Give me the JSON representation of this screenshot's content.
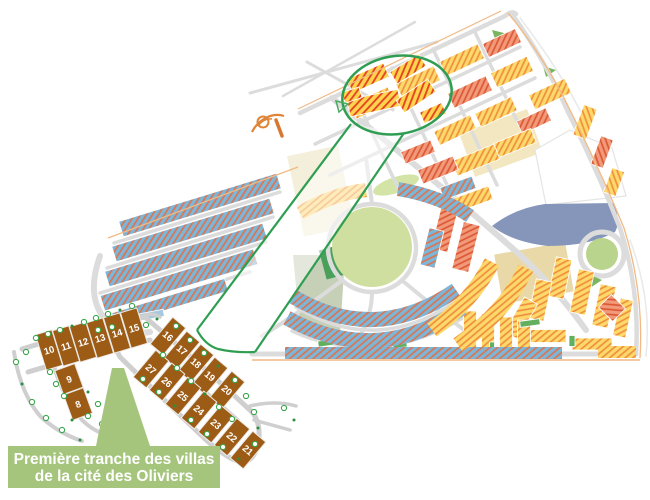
{
  "caption": {
    "line1": "Première tranche des villas",
    "line2": "de la cité des Oliviers"
  },
  "colors": {
    "parcel_brown": "#9d5c16",
    "tree_green": "#3aa64a",
    "tree_dot": "#2e8f3e",
    "caption_bg": "#a5c57d",
    "highlight_green": "#2f9e52",
    "yellow_block": "#fdd96b",
    "yellow_stripe": "#ef8b3c",
    "salmon_block": "#f2997a",
    "salmon_stripe": "#da5531",
    "blue_block": "#7cb6d9",
    "blue_stripe": "#e0714a",
    "hl_yellow": "#ffd34d",
    "hl_red_stripe": "#e33f22",
    "road_gray": "#dcdcdc",
    "boundary_orange": "#f2b983",
    "park_green": "#cfdf9f",
    "dark_green": "#4aa05a",
    "sage_green": "#c6d0b6",
    "big_block_bluegray": "#8596ba",
    "solid_green": "#62b05e",
    "pale_yellow": "#f7e8ac",
    "pale_blue": "#a6c8e0"
  },
  "inset": {
    "parcels": [
      {
        "n": "8",
        "x": 78,
        "y": 404,
        "w": 21,
        "h": 27,
        "r": -20
      },
      {
        "n": "9",
        "x": 69,
        "y": 379,
        "w": 21,
        "h": 25,
        "r": -20
      },
      {
        "n": "10",
        "x": 49,
        "y": 350,
        "w": 17,
        "h": 37,
        "r": -17
      },
      {
        "n": "11",
        "x": 66,
        "y": 346,
        "w": 17,
        "h": 37,
        "r": -17
      },
      {
        "n": "12",
        "x": 83,
        "y": 342,
        "w": 17,
        "h": 37,
        "r": -17
      },
      {
        "n": "13",
        "x": 100,
        "y": 338,
        "w": 17,
        "h": 37,
        "r": -17
      },
      {
        "n": "14",
        "x": 117,
        "y": 333,
        "w": 17,
        "h": 37,
        "r": -17
      },
      {
        "n": "15",
        "x": 134,
        "y": 328,
        "w": 17,
        "h": 37,
        "r": -17
      },
      {
        "n": "16",
        "x": 168,
        "y": 336,
        "w": 17,
        "h": 35,
        "r": 40
      },
      {
        "n": "17",
        "x": 182,
        "y": 350,
        "w": 17,
        "h": 35,
        "r": 40
      },
      {
        "n": "18",
        "x": 196,
        "y": 363,
        "w": 17,
        "h": 35,
        "r": 40
      },
      {
        "n": "19",
        "x": 210,
        "y": 376,
        "w": 17,
        "h": 35,
        "r": 40
      },
      {
        "n": "20",
        "x": 227,
        "y": 390,
        "w": 17,
        "h": 35,
        "r": 40
      },
      {
        "n": "21",
        "x": 248,
        "y": 450,
        "w": 17,
        "h": 35,
        "r": 40
      },
      {
        "n": "22",
        "x": 232,
        "y": 437,
        "w": 17,
        "h": 35,
        "r": 40
      },
      {
        "n": "23",
        "x": 216,
        "y": 424,
        "w": 17,
        "h": 35,
        "r": 40
      },
      {
        "n": "24",
        "x": 199,
        "y": 410,
        "w": 17,
        "h": 35,
        "r": 40
      },
      {
        "n": "25",
        "x": 183,
        "y": 396,
        "w": 17,
        "h": 35,
        "r": 40
      },
      {
        "n": "26",
        "x": 167,
        "y": 382,
        "w": 17,
        "h": 35,
        "r": 40
      },
      {
        "n": "27",
        "x": 151,
        "y": 369,
        "w": 17,
        "h": 35,
        "r": 40
      }
    ],
    "trees": [
      [
        36,
        338
      ],
      [
        48,
        334
      ],
      [
        60,
        330
      ],
      [
        72,
        326
      ],
      [
        84,
        322
      ],
      [
        96,
        318
      ],
      [
        108,
        314
      ],
      [
        120,
        310
      ],
      [
        132,
        306
      ],
      [
        26,
        352
      ],
      [
        16,
        362
      ],
      [
        22,
        384
      ],
      [
        32,
        402
      ],
      [
        46,
        418
      ],
      [
        62,
        430
      ],
      [
        80,
        440
      ],
      [
        50,
        372
      ],
      [
        56,
        384
      ],
      [
        64,
        396
      ],
      [
        88,
        392
      ],
      [
        98,
        404
      ],
      [
        88,
        416
      ],
      [
        102,
        424
      ],
      [
        72,
        420
      ],
      [
        98,
        330
      ],
      [
        112,
        327
      ],
      [
        146,
        325
      ],
      [
        157,
        319
      ],
      [
        176,
        326
      ],
      [
        190,
        340
      ],
      [
        204,
        353
      ],
      [
        218,
        366
      ],
      [
        235,
        380
      ],
      [
        246,
        396
      ],
      [
        254,
        412
      ],
      [
        258,
        428
      ],
      [
        255,
        444
      ],
      [
        143,
        379
      ],
      [
        159,
        392
      ],
      [
        175,
        406
      ],
      [
        191,
        420
      ],
      [
        207,
        434
      ],
      [
        223,
        447
      ],
      [
        239,
        459
      ],
      [
        163,
        355
      ],
      [
        177,
        368
      ],
      [
        191,
        381
      ],
      [
        205,
        394
      ],
      [
        219,
        407
      ],
      [
        232,
        419
      ],
      [
        284,
        408
      ],
      [
        294,
        420
      ]
    ]
  },
  "map": {
    "blocks": [
      [
        372,
        103,
        42,
        16,
        -25,
        "y"
      ],
      [
        418,
        82,
        42,
        16,
        -25,
        "y"
      ],
      [
        462,
        60,
        42,
        16,
        -25,
        "y"
      ],
      [
        502,
        43,
        36,
        15,
        -25,
        "s"
      ],
      [
        470,
        92,
        42,
        16,
        -25,
        "s"
      ],
      [
        512,
        72,
        40,
        16,
        -25,
        "y"
      ],
      [
        550,
        94,
        40,
        16,
        -25,
        "y"
      ],
      [
        455,
        130,
        40,
        15,
        -25,
        "y"
      ],
      [
        496,
        112,
        40,
        15,
        -25,
        "y"
      ],
      [
        534,
        121,
        32,
        14,
        -25,
        "s"
      ],
      [
        476,
        160,
        46,
        16,
        -22,
        "y"
      ],
      [
        515,
        143,
        40,
        15,
        -22,
        "y"
      ],
      [
        438,
        170,
        38,
        15,
        -22,
        "s"
      ],
      [
        418,
        152,
        32,
        13,
        -22,
        "s"
      ],
      [
        585,
        122,
        32,
        14,
        -70,
        "y"
      ],
      [
        602,
        152,
        30,
        13,
        -70,
        "s"
      ],
      [
        614,
        182,
        26,
        13,
        -70,
        "y"
      ],
      [
        470,
        200,
        44,
        14,
        -20,
        "y"
      ],
      [
        458,
        188,
        34,
        13,
        -20,
        "b"
      ],
      [
        445,
        227,
        17,
        48,
        14,
        "s"
      ],
      [
        466,
        247,
        17,
        48,
        14,
        "s"
      ],
      [
        432,
        248,
        15,
        38,
        14,
        "b"
      ],
      [
        368,
        78,
        40,
        15,
        -24,
        "h"
      ],
      [
        408,
        69,
        34,
        14,
        -32,
        "h"
      ],
      [
        374,
        103,
        52,
        17,
        -12,
        "h"
      ],
      [
        416,
        96,
        38,
        15,
        -34,
        "h"
      ],
      [
        433,
        113,
        24,
        12,
        -24,
        "h"
      ],
      [
        352,
        95,
        18,
        11,
        -18,
        "h"
      ],
      [
        200,
        205,
        165,
        16,
        -17,
        "b"
      ],
      [
        193,
        230,
        165,
        16,
        -17,
        "b"
      ],
      [
        186,
        255,
        165,
        16,
        -17,
        "b"
      ],
      [
        179,
        280,
        160,
        16,
        -17,
        "b"
      ],
      [
        170,
        302,
        118,
        13,
        -17,
        "b"
      ],
      [
        560,
        278,
        16,
        40,
        12,
        "y"
      ],
      [
        582,
        292,
        16,
        44,
        12,
        "y"
      ],
      [
        604,
        306,
        16,
        42,
        12,
        "y"
      ],
      [
        623,
        318,
        13,
        38,
        12,
        "y"
      ],
      [
        540,
        300,
        16,
        40,
        12,
        "y"
      ],
      [
        521,
        318,
        15,
        40,
        30,
        "y"
      ],
      [
        546,
        336,
        40,
        13,
        0,
        "y"
      ],
      [
        592,
        344,
        40,
        12,
        0,
        "y"
      ],
      [
        612,
        308,
        20,
        18,
        45,
        "s"
      ],
      [
        470,
        330,
        13,
        38,
        0,
        "y"
      ],
      [
        488,
        332,
        13,
        36,
        0,
        "y"
      ],
      [
        506,
        334,
        13,
        34,
        0,
        "y"
      ],
      [
        524,
        336,
        13,
        32,
        0,
        "y"
      ],
      [
        530,
        323,
        20,
        6,
        -8,
        "g"
      ],
      [
        492,
        348,
        5,
        12,
        0,
        "g"
      ],
      [
        572,
        341,
        6,
        11,
        0,
        "g"
      ],
      [
        326,
        343,
        16,
        6,
        -8,
        "g"
      ],
      [
        400,
        345,
        14,
        5,
        -5,
        "g"
      ],
      [
        95,
        326,
        50,
        7,
        -11,
        "py"
      ],
      [
        152,
        315,
        24,
        7,
        -11,
        "pb"
      ]
    ],
    "arcs": [
      [
        "M292,296 Q375,346 456,290",
        15,
        "b"
      ],
      [
        "M287,318 Q378,368 462,308",
        15,
        "b"
      ],
      [
        "M285,353 L562,353",
        12,
        "b"
      ],
      [
        "M432,330 Q472,302 492,262",
        16,
        "y"
      ],
      [
        "M458,345 Q506,312 526,268",
        16,
        "y"
      ],
      [
        "M300,213 Q332,194 366,190",
        14,
        "y"
      ],
      [
        "M398,189 Q440,196 470,216",
        14,
        "b"
      ],
      [
        "M598,352 L636,352",
        12,
        "y"
      ]
    ]
  }
}
